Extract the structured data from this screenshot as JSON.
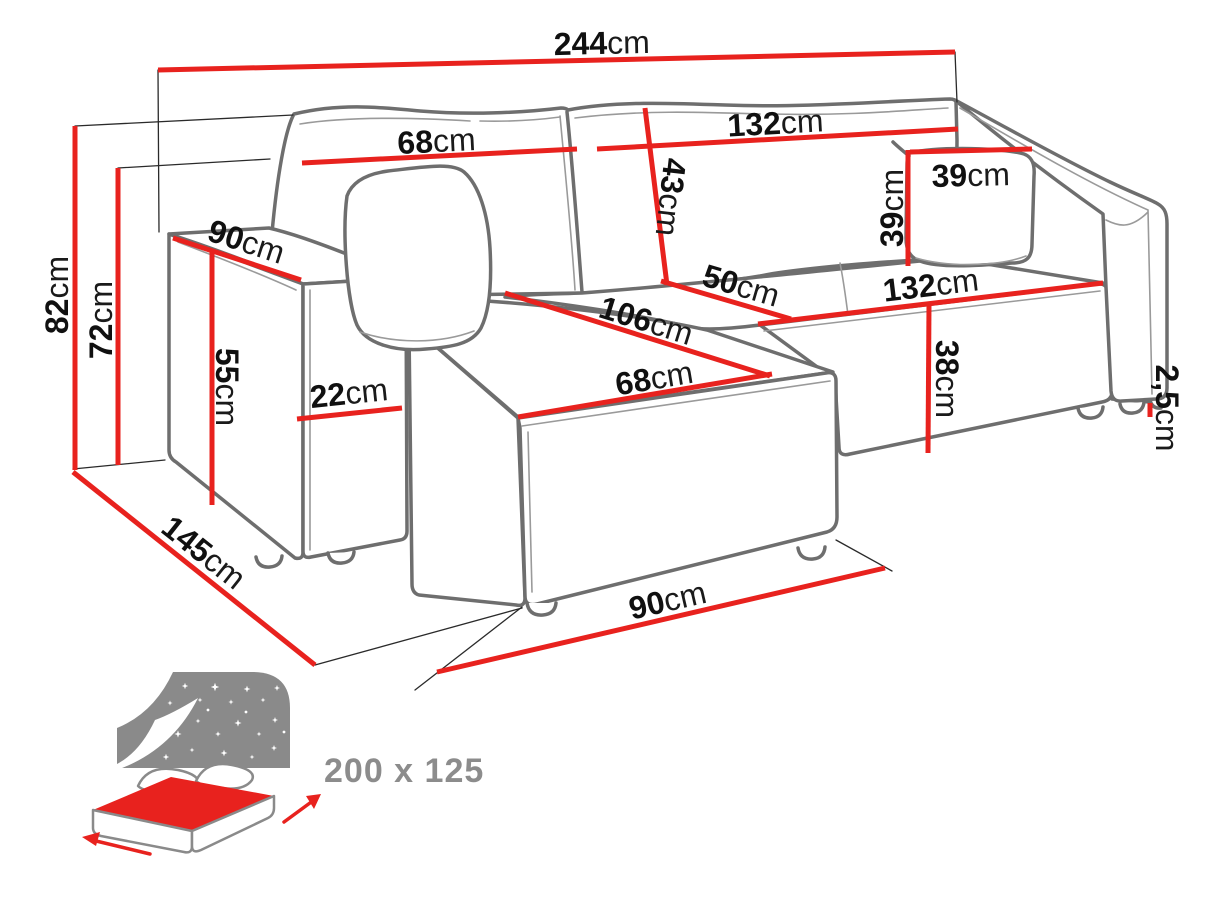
{
  "diagram": {
    "title_semantic": "corner-sofa-dimension-diagram",
    "unit": "cm",
    "dims": {
      "total_width": {
        "value": "244",
        "unit": "cm"
      },
      "backrest_left_width": {
        "value": "68",
        "unit": "cm"
      },
      "backrest_right_width": {
        "value": "132",
        "unit": "cm"
      },
      "backrest_height": {
        "value": "43",
        "unit": "cm"
      },
      "pillow_width": {
        "value": "39",
        "unit": "cm"
      },
      "pillow_height": {
        "value": "39",
        "unit": "cm"
      },
      "total_height": {
        "value": "82",
        "unit": "cm"
      },
      "frame_height": {
        "value": "72",
        "unit": "cm"
      },
      "armrest_depth": {
        "value": "90",
        "unit": "cm"
      },
      "armrest_height": {
        "value": "55",
        "unit": "cm"
      },
      "armrest_width": {
        "value": "22",
        "unit": "cm"
      },
      "chaise_length": {
        "value": "106",
        "unit": "cm"
      },
      "seat_depth": {
        "value": "50",
        "unit": "cm"
      },
      "seat_width": {
        "value": "132",
        "unit": "cm"
      },
      "seat_height": {
        "value": "38",
        "unit": "cm"
      },
      "chaise_width": {
        "value": "68",
        "unit": "cm"
      },
      "total_depth": {
        "value": "145",
        "unit": "cm"
      },
      "front_depth": {
        "value": "90",
        "unit": "cm"
      },
      "leg_height": {
        "value": "2,5",
        "unit": "cm"
      }
    },
    "sleeping_area": {
      "label": "200 x 125",
      "icon": "bed-starry-night-icon"
    },
    "colors": {
      "dimension_red": "#e8221e",
      "outline_gray": "#6e6e6e",
      "label_black": "#101010",
      "icon_gray": "#8a8a8a",
      "sleep_text_gray": "#8c8c8c"
    }
  }
}
